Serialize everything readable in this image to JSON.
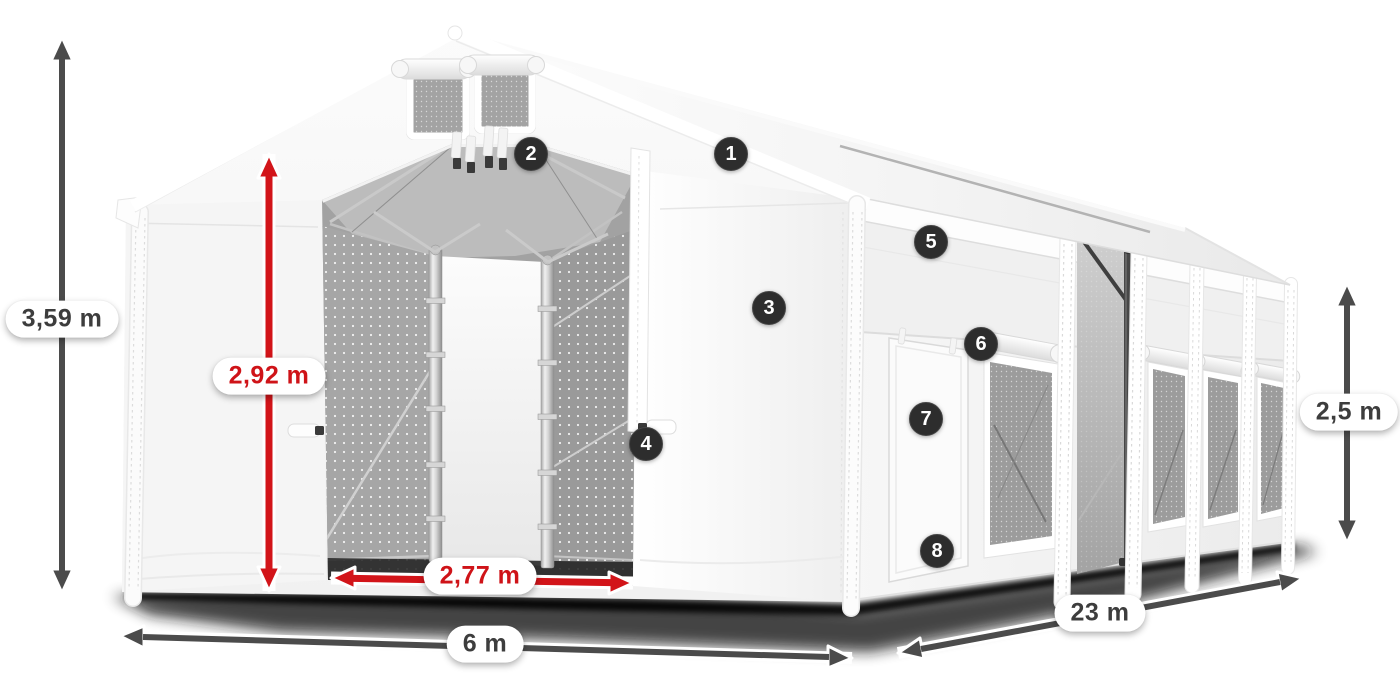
{
  "colors": {
    "arrow_dark": "#4b4b4b",
    "arrow_red": "#d21419",
    "text_dark": "#3d3d3d",
    "text_red": "#cf1318",
    "pill_bg": "#ffffff",
    "callout_bg": "#2d2d2d",
    "callout_text": "#ffffff"
  },
  "dimensions": [
    {
      "id": "total-height",
      "text": "3,59 m",
      "style": "dark"
    },
    {
      "id": "entrance-height",
      "text": "2,92 m",
      "style": "red"
    },
    {
      "id": "entrance-width",
      "text": "2,77 m",
      "style": "red"
    },
    {
      "id": "tent-width",
      "text": "6 m",
      "style": "dark"
    },
    {
      "id": "tent-length",
      "text": "23 m",
      "style": "dark"
    },
    {
      "id": "side-wall-height",
      "text": "2,5 m",
      "style": "dark"
    }
  ],
  "callouts": [
    {
      "number": "1"
    },
    {
      "number": "2"
    },
    {
      "number": "3"
    },
    {
      "number": "4"
    },
    {
      "number": "5"
    },
    {
      "number": "6"
    },
    {
      "number": "7"
    },
    {
      "number": "8"
    }
  ]
}
